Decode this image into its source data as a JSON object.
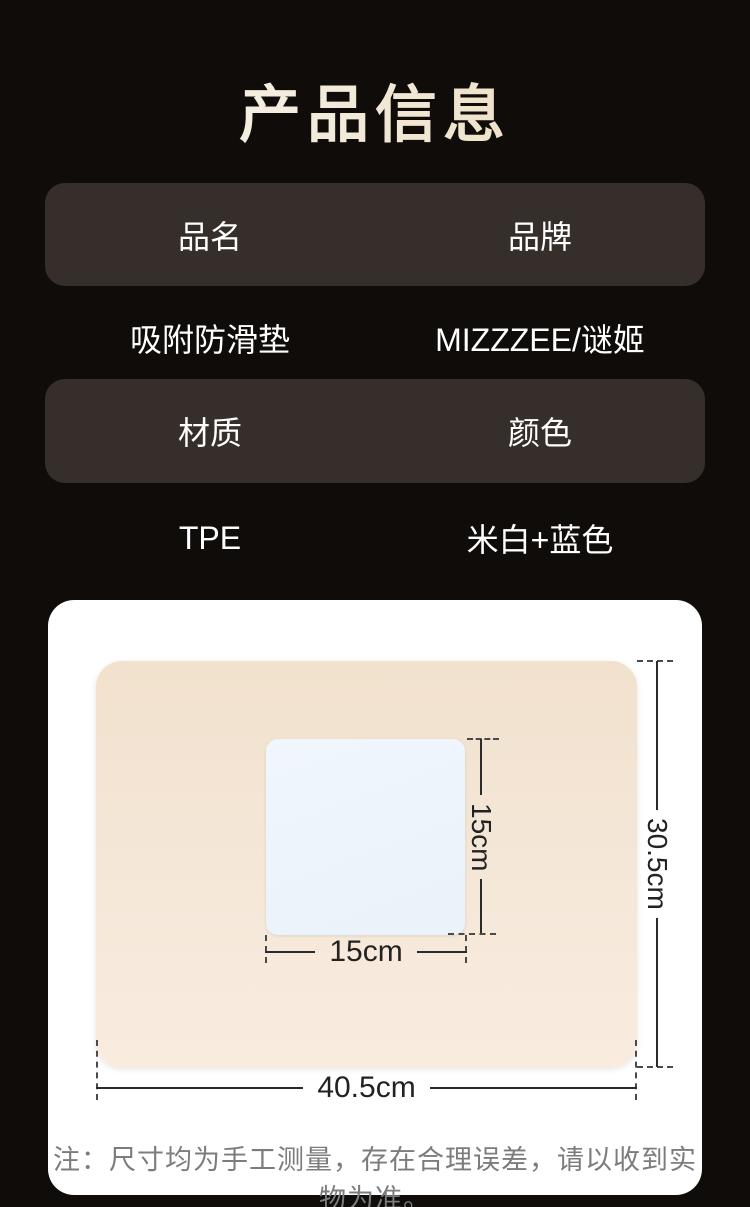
{
  "title": "产品信息",
  "info_table": {
    "row1_header": [
      "品名",
      "品牌"
    ],
    "row1_values": [
      "吸附防滑垫",
      "MIZZZEE/谜姬"
    ],
    "row2_header": [
      "材质",
      "颜色"
    ],
    "row2_values": [
      "TPE",
      "米白+蓝色"
    ]
  },
  "diagram": {
    "inner_height_label": "15cm",
    "inner_width_label": "15cm",
    "outer_height_label": "30.5cm",
    "outer_width_label": "40.5cm",
    "note": "注：尺寸均为手工测量，存在合理误差，请以收到实物为准。"
  },
  "colors": {
    "background": "#0f0c0a",
    "header_row_bg": "#362e2b",
    "title_gradient_start": "#fbf9f6",
    "title_gradient_end": "#e9d6b4",
    "card_bg": "#ffffff",
    "mat_beige": "#f4e6d6",
    "square_blue": "#edf4fb",
    "dim_line": "#2b2b2b",
    "note_gray": "#7c7c7c",
    "text_white": "#ffffff"
  }
}
